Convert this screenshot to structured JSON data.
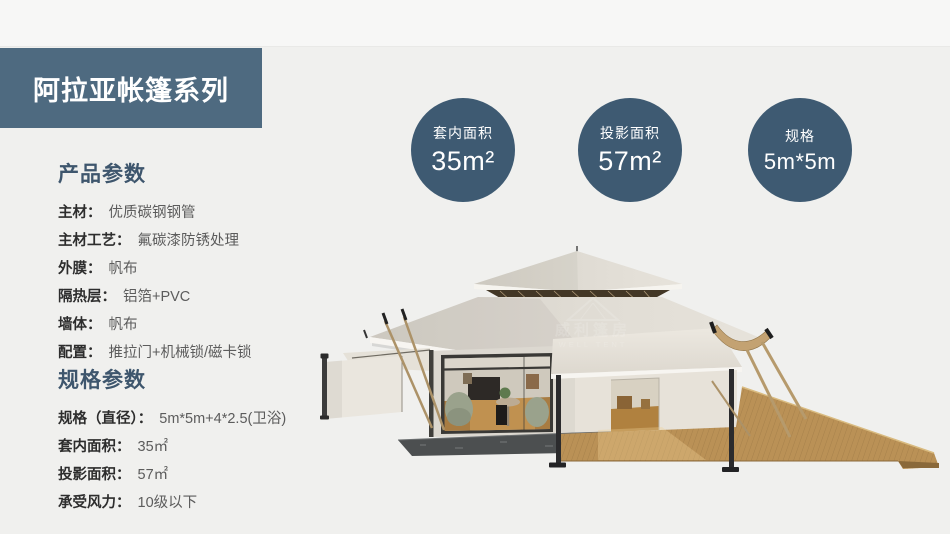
{
  "banner": {
    "title": "阿拉亚帐篷系列"
  },
  "stats": [
    {
      "label": "套内面积",
      "value": "35m²"
    },
    {
      "label": "投影面积",
      "value": "57m²"
    },
    {
      "label": "规格",
      "value": "5m*5m"
    }
  ],
  "product_params": {
    "heading": "产品参数",
    "rows": [
      {
        "label": "主材：",
        "value": "优质碳钢钢管"
      },
      {
        "label": "主材工艺：",
        "value": "氟碳漆防锈处理"
      },
      {
        "label": "外膜：",
        "value": "帆布"
      },
      {
        "label": "隔热层：",
        "value": "铝箔+PVC"
      },
      {
        "label": "墙体：",
        "value": "帆布"
      },
      {
        "label": "配置：",
        "value": "推拉门+机械锁/磁卡锁"
      }
    ]
  },
  "spec_params": {
    "heading": "规格参数",
    "rows": [
      {
        "label": "规格（直径）：",
        "value": "5m*5m+4*2.5(卫浴)"
      },
      {
        "label": "套内面积：",
        "value": "35㎡"
      },
      {
        "label": "投影面积：",
        "value": "57㎡"
      },
      {
        "label": "承受风力：",
        "value": "10级以下"
      }
    ]
  },
  "watermark": {
    "cn": "威利篷房",
    "en": "WELL TENT"
  },
  "colors": {
    "banner_bg": "#4e6a80",
    "circle_bg": "#3e5a72",
    "heading": "#3e566d",
    "page_bg": "#f0f0ee",
    "canvas": "#dcd8d0",
    "deck_wood": "#ba9156"
  }
}
